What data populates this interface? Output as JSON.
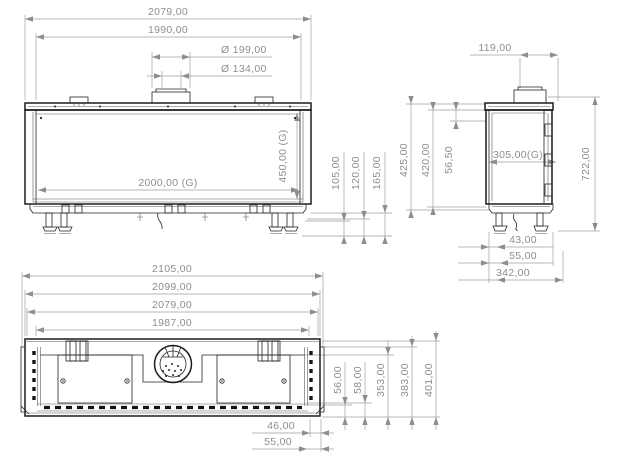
{
  "drawing": {
    "front": {
      "width_overall": "2079,00",
      "width_inner": "1990,00",
      "flue_dia_outer": "Ø 199,00",
      "flue_dia_inner": "Ø 134,00",
      "glass_width": "2000,00 (G)",
      "glass_height": "450,00 (G)",
      "plinth_height_1": "105,00",
      "plinth_height_2": "120,00",
      "plinth_height_3": "165,00"
    },
    "side": {
      "flue_offset": "119,00",
      "top_depth": "56,50",
      "depth_inner_1": "425,00",
      "depth_inner_2": "420,00",
      "glass_depth": "305,00(G)",
      "height_overall": "722,00",
      "foot_offset_1": "43,00",
      "foot_offset_2": "55,00",
      "depth_overall": "342,00"
    },
    "bottom": {
      "width_1": "2105,00",
      "width_2": "2099,00",
      "width_3": "2079,00",
      "width_4": "1987,00",
      "depth_1": "56,00",
      "depth_2": "58,00",
      "depth_3": "353,00",
      "depth_4": "383,00",
      "depth_5": "401,00",
      "edge_offset_1": "46,00",
      "edge_offset_2": "55,00"
    },
    "colors": {
      "part_line": "#1b1b1b",
      "dimension_line": "#a0a0a0",
      "dimension_text": "#8e8e8e",
      "background": "#ffffff"
    }
  }
}
